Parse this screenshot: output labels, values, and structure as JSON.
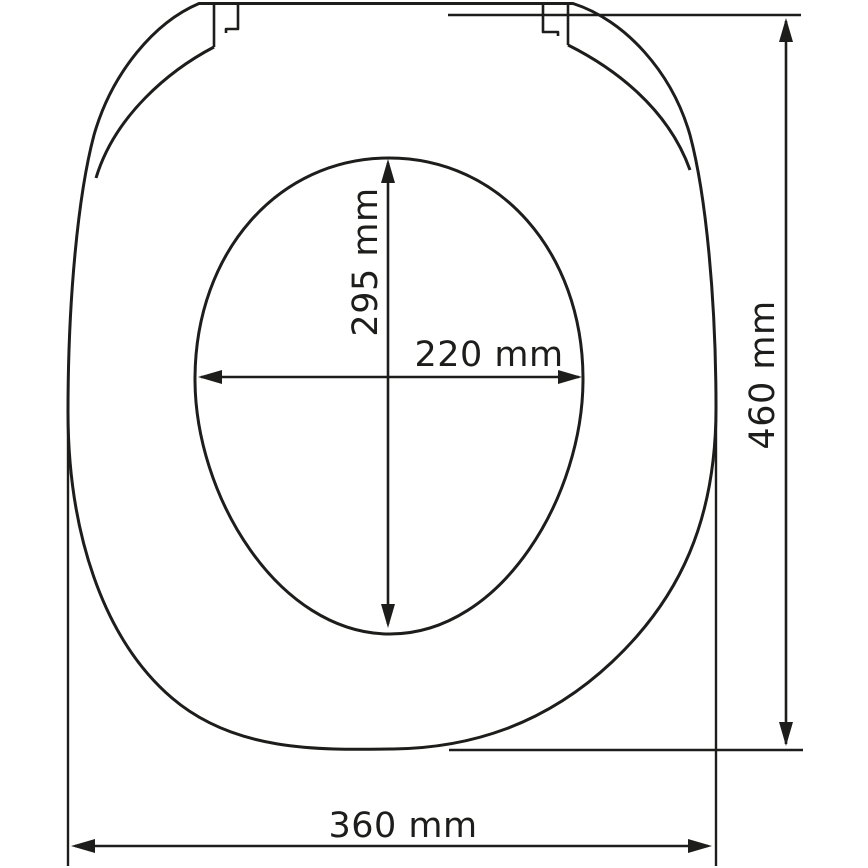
{
  "colors": {
    "line": "#1d1d1b",
    "background": "#ffffff"
  },
  "diagram": {
    "dimensions": {
      "inner_length": {
        "label": "295 mm",
        "value": 295,
        "unit": "mm",
        "orientation": "vertical"
      },
      "inner_width": {
        "label": "220 mm",
        "value": 220,
        "unit": "mm",
        "orientation": "horizontal"
      },
      "overall_length": {
        "label": "460 mm",
        "value": 460,
        "unit": "mm",
        "orientation": "vertical"
      },
      "overall_width": {
        "label": "360 mm",
        "value": 360,
        "unit": "mm",
        "orientation": "horizontal"
      }
    }
  }
}
